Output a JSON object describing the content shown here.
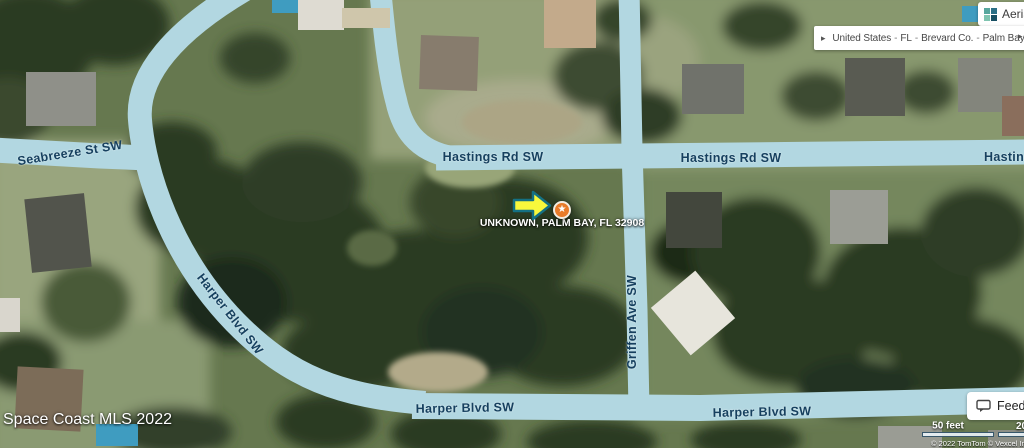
{
  "colors": {
    "road_fill": "#b2d7e1",
    "road_label_text": "#16405f",
    "marker_orange": "#e87b2a",
    "arrow_yellow": "#f8f83c",
    "arrow_outline": "#147083",
    "pool_blue": "#3f9cc0",
    "chip_background": "#ffffff",
    "chip_text": "#3c3c3c"
  },
  "header": {
    "map_type_button": {
      "label": "Aerial",
      "icon": "aerial-tiles-icon"
    },
    "breadcrumb": {
      "prev_icon": "▸",
      "next_icon": "▸",
      "separator": "-",
      "items": [
        "United States",
        "FL",
        "Brevard Co.",
        "Palm Bay"
      ]
    }
  },
  "map": {
    "marker_label": "UNKNOWN, PALM BAY, FL 32908",
    "marker_star": "★",
    "road_labels": {
      "seabreeze": "Seabreeze St SW",
      "hastings_west": "Hastings Rd SW",
      "hastings_mid": "Hastings Rd SW",
      "hastings_east": "Hastings Rd SW",
      "harper_curve": "Harper Blvd SW",
      "harper_south_west": "Harper Blvd SW",
      "harper_south_east": "Harper Blvd SW",
      "griffen": "Griffen Ave SW"
    },
    "attribution": "Space Coast MLS 2022"
  },
  "footer": {
    "feedback_label": "Feedback",
    "scale_imperial": "50 feet",
    "scale_metric": "20 m",
    "copyright": "© 2022 TomTom © Vexcel Imaging"
  }
}
